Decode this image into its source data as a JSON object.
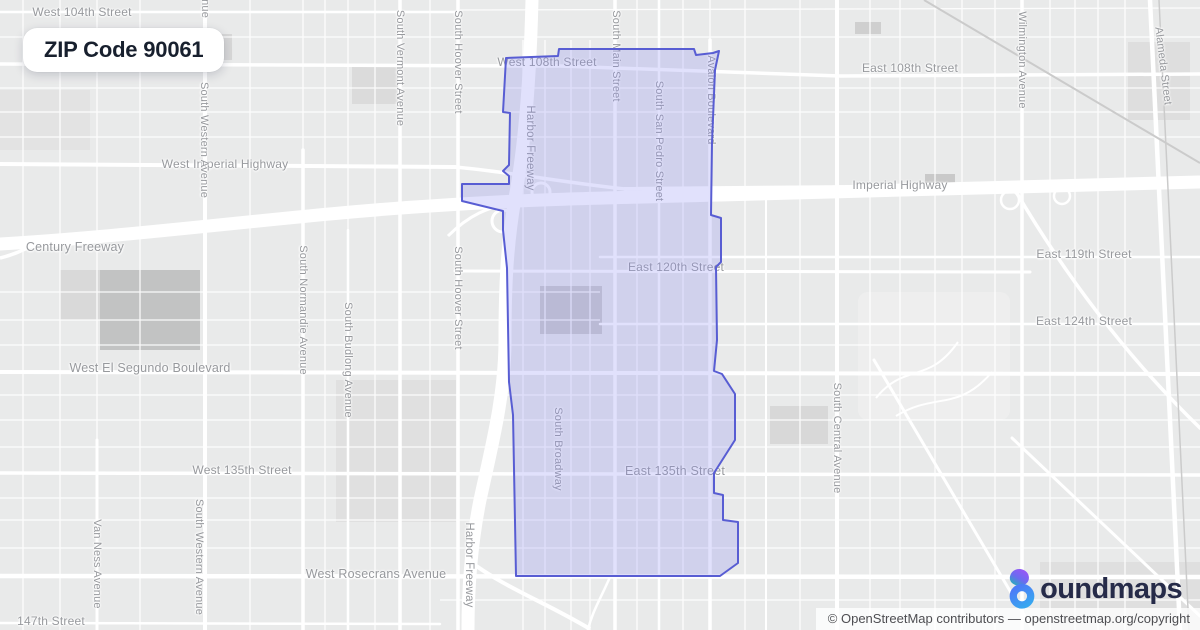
{
  "badge": {
    "label": "ZIP Code 90061"
  },
  "logo": {
    "name": "boundmaps",
    "display_text": "oundmaps",
    "icon": "boundmaps-pin-icon",
    "colors": {
      "petal_top": "#a152f7",
      "petal_bottom": "#1db8b2",
      "ring_start": "#4d7bf7",
      "ring_end": "#38a6f0",
      "text": "#262b49"
    }
  },
  "attribution": {
    "prefix": "© OpenStreetMap contributors — ",
    "link": "openstreetmap.org/copyright"
  },
  "map": {
    "boundary": {
      "label": "ZIP Code 90061 boundary",
      "stroke": "#585dd3",
      "fill": "rgba(138,141,245,0.26)",
      "stroke_width": 2,
      "points": [
        [
          506,
          58
        ],
        [
          558,
          56
        ],
        [
          559,
          49
        ],
        [
          694,
          49
        ],
        [
          696,
          55
        ],
        [
          713,
          53
        ],
        [
          719,
          51
        ],
        [
          715,
          70
        ],
        [
          712,
          143
        ],
        [
          711,
          215
        ],
        [
          721,
          218
        ],
        [
          721,
          262
        ],
        [
          716,
          267
        ],
        [
          717,
          340
        ],
        [
          714,
          371
        ],
        [
          722,
          374
        ],
        [
          735,
          394
        ],
        [
          735,
          440
        ],
        [
          714,
          473
        ],
        [
          714,
          493
        ],
        [
          723,
          495
        ],
        [
          723,
          520
        ],
        [
          738,
          522
        ],
        [
          738,
          563
        ],
        [
          720,
          576
        ],
        [
          516,
          576
        ],
        [
          515,
          522
        ],
        [
          513,
          415
        ],
        [
          509,
          382
        ],
        [
          507,
          268
        ],
        [
          503,
          230
        ],
        [
          503,
          211
        ],
        [
          462,
          201
        ],
        [
          462,
          184
        ],
        [
          509,
          184
        ],
        [
          509,
          176
        ],
        [
          503,
          171
        ],
        [
          509,
          165
        ],
        [
          510,
          113
        ],
        [
          503,
          112
        ]
      ]
    },
    "street_labels": [
      {
        "t": "West 104th Street",
        "x": 82,
        "y": 12,
        "r": 0,
        "s": 12
      },
      {
        "t": "West 108th Street",
        "x": 100,
        "y": 63,
        "r": 0,
        "s": 12
      },
      {
        "t": "West 108th Street",
        "x": 547,
        "y": 62,
        "r": 0,
        "s": 12
      },
      {
        "t": "East 108th Street",
        "x": 910,
        "y": 68,
        "r": 0,
        "s": 12
      },
      {
        "t": "West Imperial Highway",
        "x": 225,
        "y": 164,
        "r": 0,
        "s": 12
      },
      {
        "t": "Imperial Highway",
        "x": 900,
        "y": 185,
        "r": 0,
        "s": 12
      },
      {
        "t": "Century Freeway",
        "x": 75,
        "y": 247,
        "r": 0,
        "s": 12.5
      },
      {
        "t": "East 119th Street",
        "x": 1084,
        "y": 254,
        "r": 0,
        "s": 12
      },
      {
        "t": "East 120th Street",
        "x": 676,
        "y": 267,
        "r": 0,
        "s": 12
      },
      {
        "t": "East 124th Street",
        "x": 1084,
        "y": 321,
        "r": 0,
        "s": 12
      },
      {
        "t": "West El Segundo Boulevard",
        "x": 150,
        "y": 368,
        "r": 0,
        "s": 12.5
      },
      {
        "t": "West 135th Street",
        "x": 242,
        "y": 470,
        "r": 0,
        "s": 12
      },
      {
        "t": "East 135th Street",
        "x": 675,
        "y": 471,
        "r": 0,
        "s": 12.5
      },
      {
        "t": "West Rosecrans Avenue",
        "x": 376,
        "y": 574,
        "r": 0,
        "s": 12.5
      },
      {
        "t": "147th Street",
        "x": 51,
        "y": 621,
        "r": 0,
        "s": 12
      },
      {
        "t": "South Western Avenue",
        "x": 205,
        "y": -40,
        "r": 90,
        "s": 11
      },
      {
        "t": "South Western Avenue",
        "x": 204,
        "y": 140,
        "r": 90,
        "s": 11
      },
      {
        "t": "South Western Avenue",
        "x": 199,
        "y": 557,
        "r": 90,
        "s": 11
      },
      {
        "t": "Van Ness Avenue",
        "x": 97,
        "y": 564,
        "r": 90,
        "s": 11
      },
      {
        "t": "South Normandie Avenue",
        "x": 303,
        "y": 310,
        "r": 90,
        "s": 11
      },
      {
        "t": "South Budlong Avenue",
        "x": 348,
        "y": 360,
        "r": 90,
        "s": 11
      },
      {
        "t": "South Vermont Avenue",
        "x": 400,
        "y": 68,
        "r": 90,
        "s": 11
      },
      {
        "t": "South Hoover Street",
        "x": 458,
        "y": 62,
        "r": 90,
        "s": 11
      },
      {
        "t": "South Hoover Street",
        "x": 458,
        "y": 298,
        "r": 90,
        "s": 11
      },
      {
        "t": "Harbor Freeway",
        "x": 530,
        "y": 148,
        "r": 90,
        "s": 11.5
      },
      {
        "t": "Harbor Freeway",
        "x": 469,
        "y": 565,
        "r": 90,
        "s": 11.5
      },
      {
        "t": "South Main Street",
        "x": 616,
        "y": 56,
        "r": 90,
        "s": 11
      },
      {
        "t": "South San Pedro Street",
        "x": 659,
        "y": 141,
        "r": 90,
        "s": 11
      },
      {
        "t": "Avalon Boulevard",
        "x": 711,
        "y": 100,
        "r": 90,
        "s": 11
      },
      {
        "t": "South Broadway",
        "x": 558,
        "y": 449,
        "r": 90,
        "s": 11
      },
      {
        "t": "South Central Avenue",
        "x": 837,
        "y": 438,
        "r": 90,
        "s": 11
      },
      {
        "t": "Wilmington Avenue",
        "x": 1022,
        "y": 60,
        "r": 90,
        "s": 11
      },
      {
        "t": "Alameda Street",
        "x": 1163,
        "y": 66,
        "r": 83,
        "s": 11
      }
    ]
  }
}
